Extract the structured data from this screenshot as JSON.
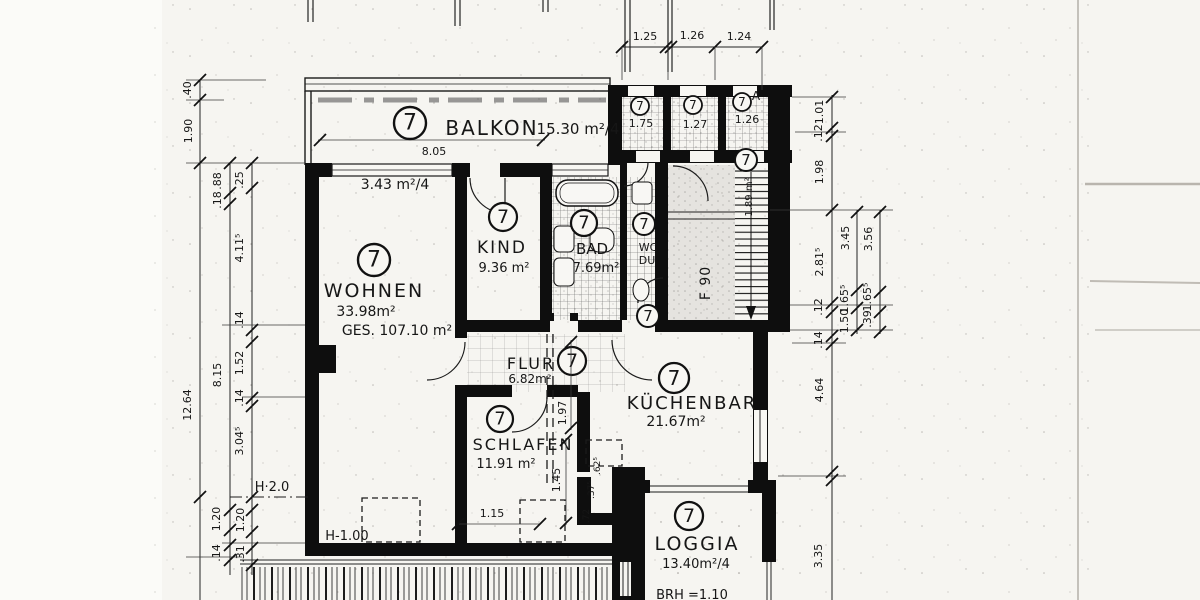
{
  "plan_title": "Wohnungsgrundriss Nr. 7",
  "rooms": {
    "balkon": {
      "nr": "7",
      "name": "BALKON",
      "area": "15.30 m²/4",
      "width": "8.05"
    },
    "wohnen": {
      "nr": "7",
      "name": "WOHNEN",
      "area": "33.98m²",
      "total": "GES. 107.10 m²",
      "window_share": "3.43 m²/4"
    },
    "kind": {
      "nr": "7",
      "name": "KIND",
      "area": "9.36 m²"
    },
    "bad": {
      "nr": "7",
      "name": "BAD",
      "area": "7.69m²"
    },
    "wc": {
      "nr": "7",
      "line1": "WC",
      "line2": "DU",
      "door_nr": "7"
    },
    "flur": {
      "nr": "7",
      "name": "FLUR",
      "area": "6.82m²"
    },
    "kuechenbar": {
      "nr": "7",
      "name": "KÜCHENBAR",
      "area": "21.67m²"
    },
    "schlafen": {
      "nr": "7",
      "name": "SCHLAFEN",
      "area": "11.91 m²"
    },
    "loggia": {
      "nr": "7",
      "name": "LOGGIA",
      "area": "13.40m²/4",
      "sill": "BRH =1.10"
    },
    "abstell": [
      {
        "nr": "7",
        "area": "1.75"
      },
      {
        "nr": "7",
        "area": "1.27"
      },
      {
        "nr": "7",
        "area": "1.26",
        "tag": "A"
      }
    ],
    "treppenhaus": {
      "nr": "7",
      "area": "1.89 m²",
      "fire_rating": "F 90"
    }
  },
  "dims": {
    "top": [
      "1.25",
      "1.26",
      "1.24"
    ],
    "left_outer": [
      ".40",
      "1.90",
      "12.64"
    ],
    "left_mid": [
      ".88",
      ".18",
      "8.15",
      "1.20",
      ".14"
    ],
    "left_inner": [
      ".25",
      "4.11⁵",
      ".14",
      "1.52",
      ".14",
      "3.04⁵",
      "1.20",
      ".31"
    ],
    "right_outer": [
      "1.01",
      ".12",
      "1.98",
      "2.81⁵",
      ".12",
      ".14",
      "4.64",
      "3.35"
    ],
    "right_mid": [
      "3.45",
      "1.65⁵",
      "1.50"
    ],
    "right_inner": [
      "3.56",
      "1.65⁵",
      ".39"
    ]
  },
  "ann": {
    "h20": "H·2.0",
    "h100": "H-1.00",
    "w115": "1.15",
    "s197": "1.97",
    "s145": "1.45",
    "s62": ".62⁵",
    "s37": ".37⁵",
    "s72": ".72"
  },
  "colors": {
    "ink": "#161616",
    "paper": "#f6f5f1"
  }
}
